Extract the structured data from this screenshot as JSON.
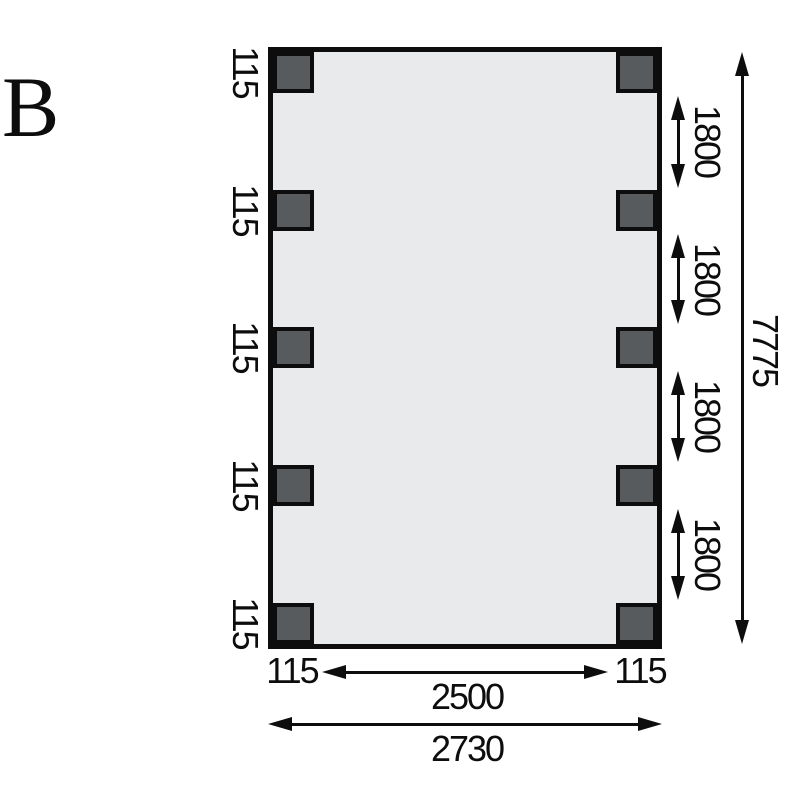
{
  "figure_label": "B",
  "colors": {
    "post_fill": "#575b5e",
    "plan_fill": "#e9eaec",
    "line": "#0d0d0d"
  },
  "plan": {
    "left_post_width_labels": [
      "115",
      "115",
      "115",
      "115",
      "115"
    ],
    "right_gap_labels": [
      "1800",
      "1800",
      "1800",
      "1800"
    ],
    "total_height_label": "7775",
    "bottom_left_post_label": "115",
    "bottom_inner_span_label": "2500",
    "bottom_right_post_label": "115",
    "bottom_total_width_label": "2730"
  }
}
